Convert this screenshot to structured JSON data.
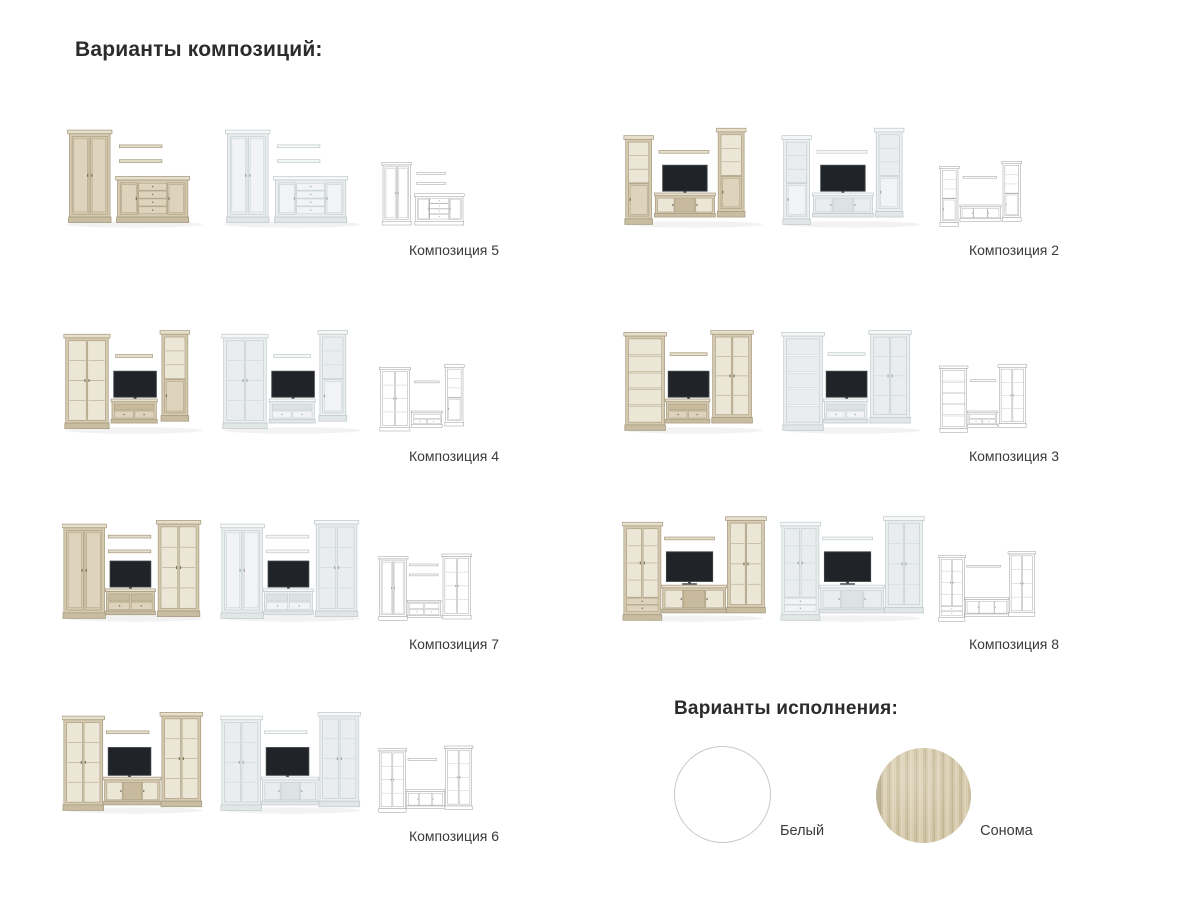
{
  "page": {
    "title": "Варианты композиций:",
    "background": "#ffffff"
  },
  "compositions": {
    "items": [
      {
        "label": "Композиция 5",
        "scheme": "c5"
      },
      {
        "label": "Композиция 2",
        "scheme": "c2"
      },
      {
        "label": "Композиция 4",
        "scheme": "c4"
      },
      {
        "label": "Композиция 3",
        "scheme": "c3"
      },
      {
        "label": "Композиция 7",
        "scheme": "c7"
      },
      {
        "label": "Композиция 8",
        "scheme": "c8"
      },
      {
        "label": "Композиция 6",
        "scheme": "c6"
      }
    ],
    "variants_per_item": [
      "sonoma-render",
      "white-render",
      "line-scheme"
    ]
  },
  "finishes": {
    "title": "Варианты исполнения:",
    "options": [
      {
        "label": "Белый",
        "color": "#ffffff"
      },
      {
        "label": "Сонома",
        "color": "#cfc3a6"
      }
    ]
  },
  "palettes": {
    "sonoma": {
      "top": "#e6dfcb",
      "body": "#d6cab0",
      "plinth": "#c8bca1",
      "edge": "#a79c80",
      "glass": "#ece6d7",
      "shelf": "#b9ad90",
      "drawer": "#ded4bd",
      "inner": "#c7ba9d",
      "knob": "#7e7359"
    },
    "white": {
      "top": "#f6f8f8",
      "body": "#eceff0",
      "plinth": "#e1e6e7",
      "edge": "#c2cbce",
      "glass": "#e9edee",
      "shelf": "#d1d9db",
      "drawer": "#f1f3f4",
      "inner": "#dde3e5",
      "knob": "#a2abae"
    },
    "line": {
      "top": "#ffffff",
      "body": "#ffffff",
      "plinth": "#ffffff",
      "edge": "#9e9e9e",
      "glass": "#ffffff",
      "shelf": "#c4c4c4",
      "drawer": "#ffffff",
      "inner": "#ffffff",
      "knob": "#9e9e9e",
      "noTV": true
    }
  },
  "tv": {
    "screen": "#202327",
    "bezel": "#3c4043",
    "stand": "#35383c"
  },
  "text_colors": {
    "label": "#3a3a3a",
    "title": "#2b2b2b"
  }
}
